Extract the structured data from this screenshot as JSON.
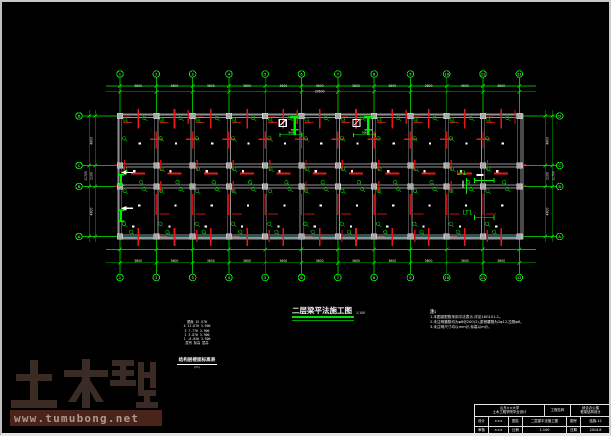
{
  "window": {
    "frame_color": "#c6c6c6",
    "background": "#000000"
  },
  "watermark": {
    "brand": "土木帮",
    "url": "www.tumubong.net",
    "brand_color": "#3a2c24",
    "bar_color": "#4a241b",
    "url_color": "#ab9a8e"
  },
  "drawing": {
    "title": {
      "text": "二层梁平法施工图",
      "scale": "1:100",
      "underline_color": "#00e000"
    },
    "notes": {
      "heading": "注:",
      "lines": [
        "1.本图梁配筋采用平法表示,详见16G101-1。",
        "2.未注明箍筋均为φ8@200(2),梁侧腰筋为2φ12,拉筋φ6。",
        "3.未注明尺寸均以mm计,标高以m计。"
      ]
    },
    "legend": {
      "rows": [
        "屋面  15.570",
        "4   11.670  3.900",
        "3    7.770  3.900",
        "2    3.870  3.900",
        "1   -0.030  3.900",
        "层号  标高   层高"
      ],
      "caption": "结构层楼面标高表",
      "sub": "(m)"
    },
    "titleblock": {
      "rows": [
        {
          "h": 12,
          "cells": [
            {
              "w": 70,
              "t": [
                "山东××大学",
                "土木工程学院毕业设计"
              ]
            },
            {
              "w": 26,
              "t": [
                "工程名称"
              ]
            },
            {
              "w": 40,
              "t": [
                "综合办公楼",
                "框架结构设计"
              ]
            }
          ]
        },
        {
          "h": 10,
          "cells": [
            {
              "w": 14,
              "t": [
                "设计"
              ]
            },
            {
              "w": 20,
              "t": [
                "×××"
              ]
            },
            {
              "w": 14,
              "t": [
                "图名"
              ]
            },
            {
              "w": 44,
              "t": [
                "二层梁平法施工图"
              ]
            },
            {
              "w": 14,
              "t": [
                "图号"
              ]
            },
            {
              "w": 30,
              "t": [
                "结施-12"
              ]
            }
          ]
        },
        {
          "h": 9,
          "cells": [
            {
              "w": 14,
              "t": [
                "审核"
              ]
            },
            {
              "w": 20,
              "t": [
                "×××"
              ]
            },
            {
              "w": 14,
              "t": [
                "比例"
              ]
            },
            {
              "w": 44,
              "t": [
                "1:100"
              ]
            },
            {
              "w": 14,
              "t": [
                "日期"
              ]
            },
            {
              "w": 30,
              "t": [
                "2014.6"
              ]
            }
          ]
        }
      ]
    }
  },
  "plan": {
    "colors": {
      "grid": "#00b400",
      "bright": "#00ee00",
      "beam": "#8f8f8f",
      "column_fill": "#a8a8a8",
      "column_edge": "#d8d8d8",
      "slab_edge": "#3fbcbc",
      "rebar": "#c41010",
      "rebar_bright": "#e81818",
      "mark": "#00a000",
      "text": "#f0f0f0"
    },
    "col_axes": {
      "labels": [
        "1",
        "2",
        "3",
        "4",
        "5",
        "6",
        "7",
        "8",
        "9",
        "10",
        "11",
        "12"
      ],
      "start_x": 118,
      "spacing": 36.3,
      "bubble_top_y": 72,
      "bubble_bottom_y": 275.5,
      "radius": 3.3
    },
    "row_axes": {
      "labels": [
        "D",
        "C",
        "B",
        "A"
      ],
      "ys": [
        114,
        163.5,
        184.5,
        234.5
      ],
      "bubble_left_x": 77,
      "bubble_right_x": 557.7
    },
    "building": {
      "x1": 115.8,
      "y1": 111.8,
      "x2": 521,
      "y2": 237
    },
    "dims": {
      "top": {
        "lines_y": [
          84,
          89.8
        ],
        "x1": 104,
        "x2": 534,
        "span_text": "3600",
        "total_text": "39600"
      },
      "bottom": {
        "lines_y": [
          247.5,
          260.8
        ],
        "x1": 104,
        "x2": 534,
        "span_text": "3600",
        "text_y": 259
      },
      "left": {
        "lines_x": [
          87.3,
          93.3
        ],
        "y1": 108,
        "y2": 240,
        "span_texts": [
          "4800",
          "2100",
          "4800"
        ],
        "total_text": "11700"
      },
      "right": {
        "lines_x": [
          543.3,
          550.2
        ],
        "y1": 108,
        "y2": 240,
        "span_texts": [
          "4800",
          "2100",
          "4800"
        ],
        "total_text": "11700"
      }
    },
    "openings": [
      {
        "x": 277.3,
        "y": 117.3,
        "size": 7,
        "dim_text": "900"
      },
      {
        "x": 350.9,
        "y": 117.3,
        "size": 7,
        "dim_text": "900"
      }
    ],
    "stairs": [
      {
        "label": "LT1",
        "x": 451.5,
        "y": 171,
        "dim_y": 178.5
      },
      {
        "label": "LT1",
        "x": 457.5,
        "y": 210.5,
        "dim_y": 215.3
      }
    ],
    "section_arrows": [
      {
        "y": 170.5
      },
      {
        "y": 206.3
      }
    ]
  }
}
